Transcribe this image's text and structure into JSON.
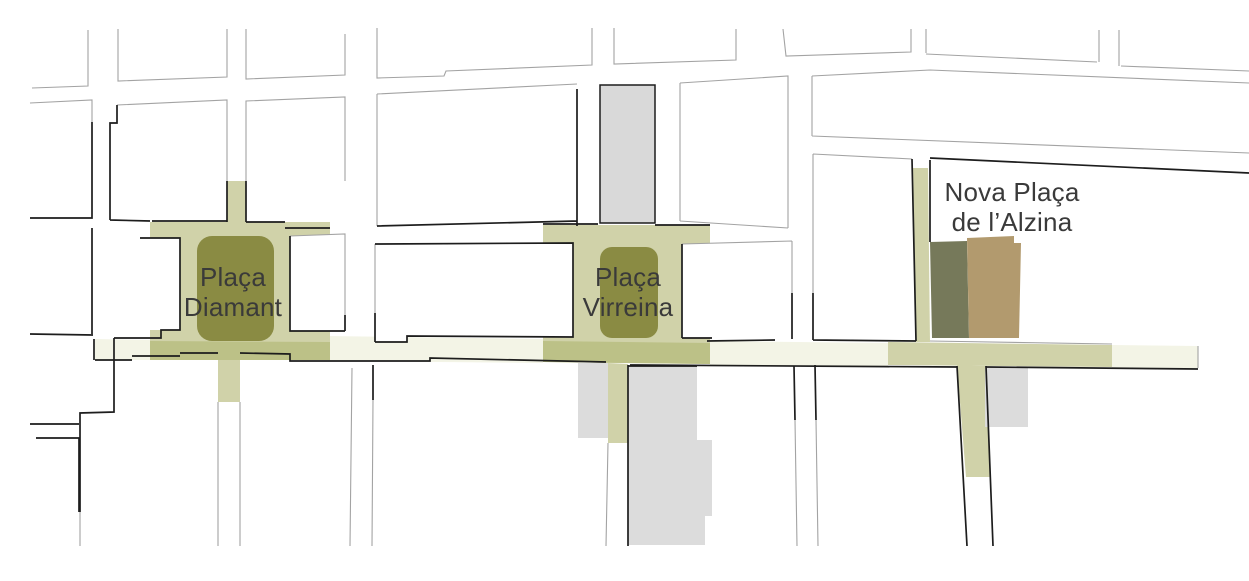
{
  "map": {
    "type": "urban-plan",
    "labels": [
      {
        "id": "placa-diamant",
        "text": "Plaça Diamant"
      },
      {
        "id": "placa-virreina",
        "text": "Plaça Virreina"
      },
      {
        "id": "nova-placa-alzina",
        "text": "Nova Plaça de l’Alzina"
      }
    ],
    "colors": {
      "background": "#ffffff",
      "plaza_green": "#8a8b43",
      "pedestrian_olive": "#d0d2a9",
      "pedestrian_olive_overlap": "#bcc187",
      "street_cream": "#f3f4e6",
      "building_gray": "#d9d9d9",
      "building_gray_light": "#dcdcdc",
      "structure_dark_green": "#76795a",
      "structure_tan": "#b29a6e",
      "outline_black": "#1d1d1d",
      "outline_gray": "#a3a3a3",
      "label_text": "#3a3a3a"
    }
  }
}
